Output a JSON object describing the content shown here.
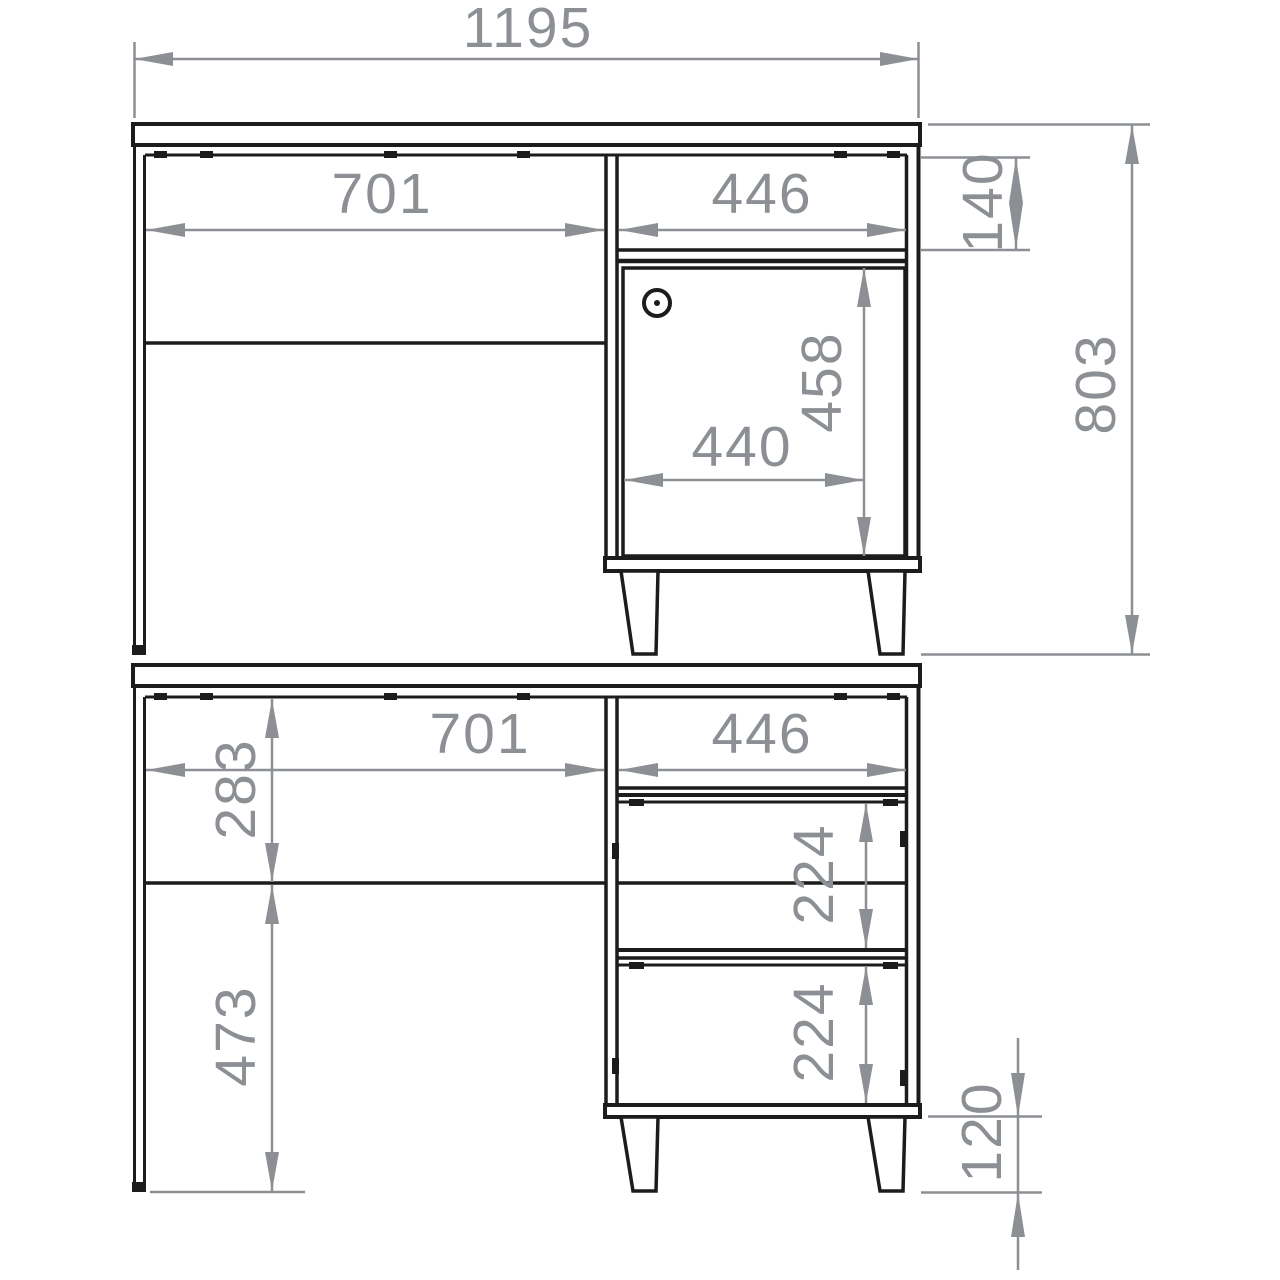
{
  "drawing": {
    "kind": "furniture-dimension-drawing",
    "colors": {
      "furniture_line": "#1c1c1a",
      "dimension": "#8c9094",
      "background": "#ffffff"
    },
    "front": {
      "overall_width": "1195",
      "left_opening_width": "701",
      "cabinet_width": "446",
      "drawer_front_height": "140",
      "overall_height": "803",
      "door_height": "458",
      "door_width": "440"
    },
    "drawers": {
      "left_opening_width": "701",
      "cabinet_width": "446",
      "upper_opening_height": "283",
      "drawer1_height": "224",
      "drawer2_height": "224",
      "lower_opening_height": "473",
      "leg_height": "120"
    }
  }
}
